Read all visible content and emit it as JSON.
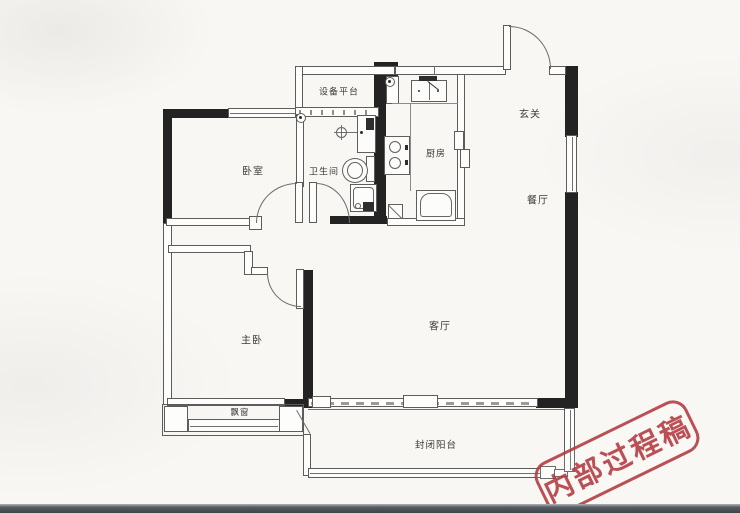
{
  "plan": {
    "rooms": {
      "equipment_platform": "设备平台",
      "entry_hall": "玄关",
      "bedroom": "卧室",
      "bathroom": "卫生间",
      "kitchen": "厨房",
      "dining_room": "餐厅",
      "master_bedroom": "主卧",
      "living_room": "客厅",
      "bay_window": "飘窗",
      "enclosed_balcony": "封闭阳台"
    },
    "stamp": {
      "text": "内部过程稿",
      "color": "#b23a40"
    },
    "colors": {
      "shear_wall": "#232323",
      "thin_wall_line": "#5c5c5c",
      "background": "#f8f7f4",
      "stamp_red": "#b23a40",
      "bottom_edge": "#3e444a"
    },
    "fixtures": [
      "entry-door",
      "bedroom-door",
      "bathroom-door",
      "master-bedroom-door",
      "kitchen-sliding-door",
      "kitchen-sink",
      "gas-stove",
      "fridge",
      "kitchen-duct",
      "bathroom-vanity",
      "faucet",
      "toilet",
      "shower-tray",
      "floor-drain-bathroom",
      "floor-drain-kitchen",
      "bay-window",
      "balcony-window",
      "living-room-window"
    ]
  }
}
